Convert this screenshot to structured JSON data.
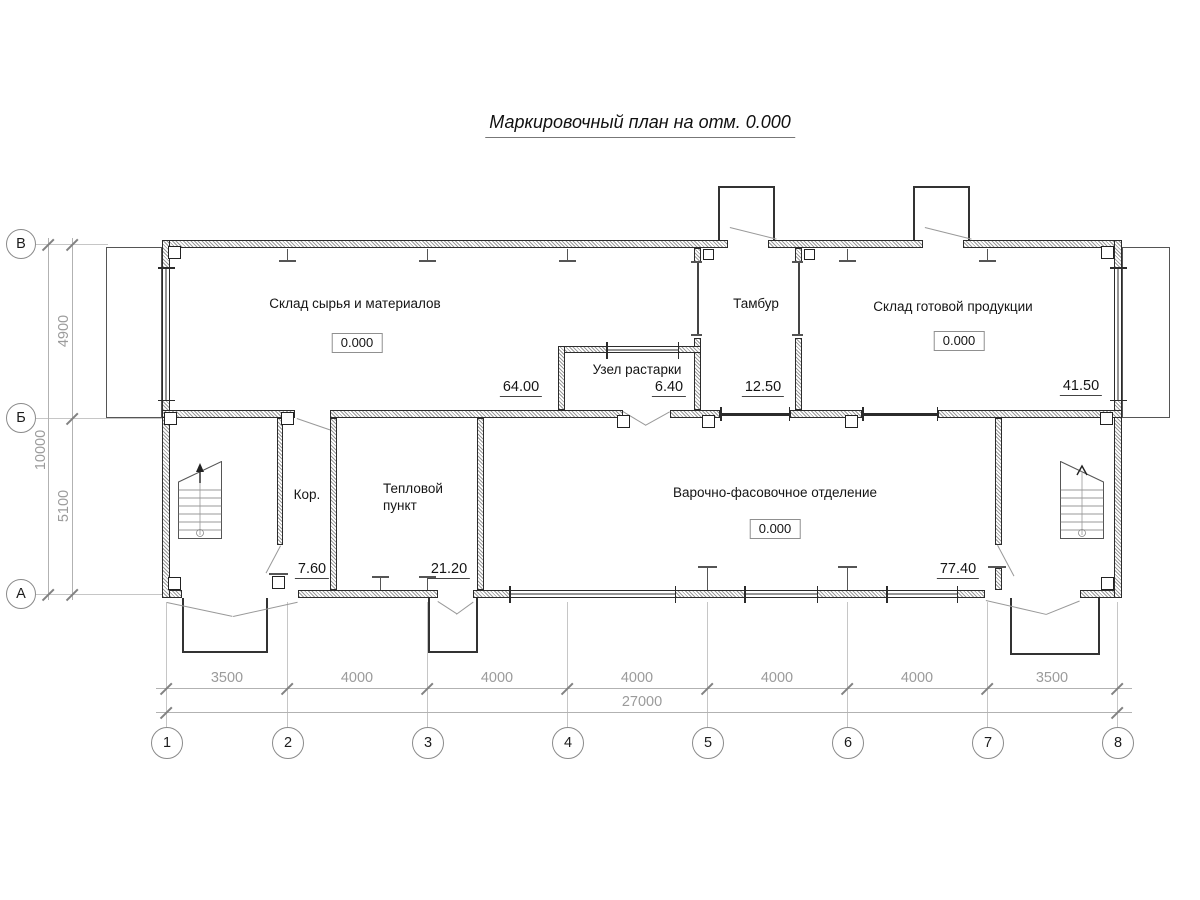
{
  "title": "Маркировочный план на отм. 0.000",
  "rooms": {
    "raw_warehouse": {
      "name": "Склад сырья и материалов",
      "elevation": "0.000",
      "number": "64.00"
    },
    "unpacking": {
      "name": "Узел растарки",
      "number": "6.40"
    },
    "vestibule": {
      "name": "Тамбур",
      "number": "12.50"
    },
    "finished_warehouse": {
      "name": "Склад готовой продукции",
      "elevation": "0.000",
      "number": "41.50"
    },
    "corridor": {
      "name": "Кор.",
      "number": "7.60"
    },
    "heat_station": {
      "name": "Тепловой пункт",
      "number": "21.20"
    },
    "cooking": {
      "name": "Варочно-фасовочное отделение",
      "elevation": "0.000",
      "number": "77.40"
    }
  },
  "axes": {
    "columns": [
      "1",
      "2",
      "3",
      "4",
      "5",
      "6",
      "7",
      "8"
    ],
    "rows": [
      "В",
      "Б",
      "А"
    ]
  },
  "dims": {
    "spans": [
      "3500",
      "4000",
      "4000",
      "4000",
      "4000",
      "4000",
      "3500"
    ],
    "total": "27000",
    "v_top": "4900",
    "v_bottom": "5100",
    "v_total": "10000"
  }
}
